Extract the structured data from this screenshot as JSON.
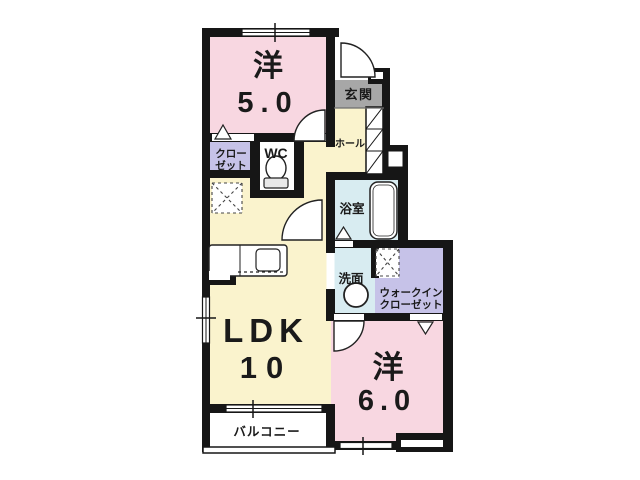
{
  "plan_title": "1LDK apartment floor plan",
  "rooms": {
    "western5": {
      "label": "洋",
      "area": "5.0"
    },
    "western6": {
      "label": "洋",
      "area": "6.0"
    },
    "ldk": {
      "label": "LDK",
      "area": "10"
    },
    "entrance": {
      "label": "玄関"
    },
    "hall": {
      "label": "ホール"
    },
    "closet": {
      "line1": "クロー",
      "line2": "ゼット"
    },
    "wc": {
      "label": "WC"
    },
    "bathroom": {
      "label": "浴室"
    },
    "washroom": {
      "label": "洗面"
    },
    "walk_in_closet": {
      "line1": "ウォークイン",
      "line2": "クローゼット"
    },
    "balcony": {
      "label": "バルコニー"
    }
  },
  "colors": {
    "room_pink": "#f8d7e1",
    "ldk_cream": "#faf3cd",
    "closet_purple": "#c6c2e8",
    "bath_blue": "#d8ecf1",
    "entrance_gray": "#a7a7a7",
    "wall_black": "#161616",
    "fixture_white": "#ffffff"
  }
}
